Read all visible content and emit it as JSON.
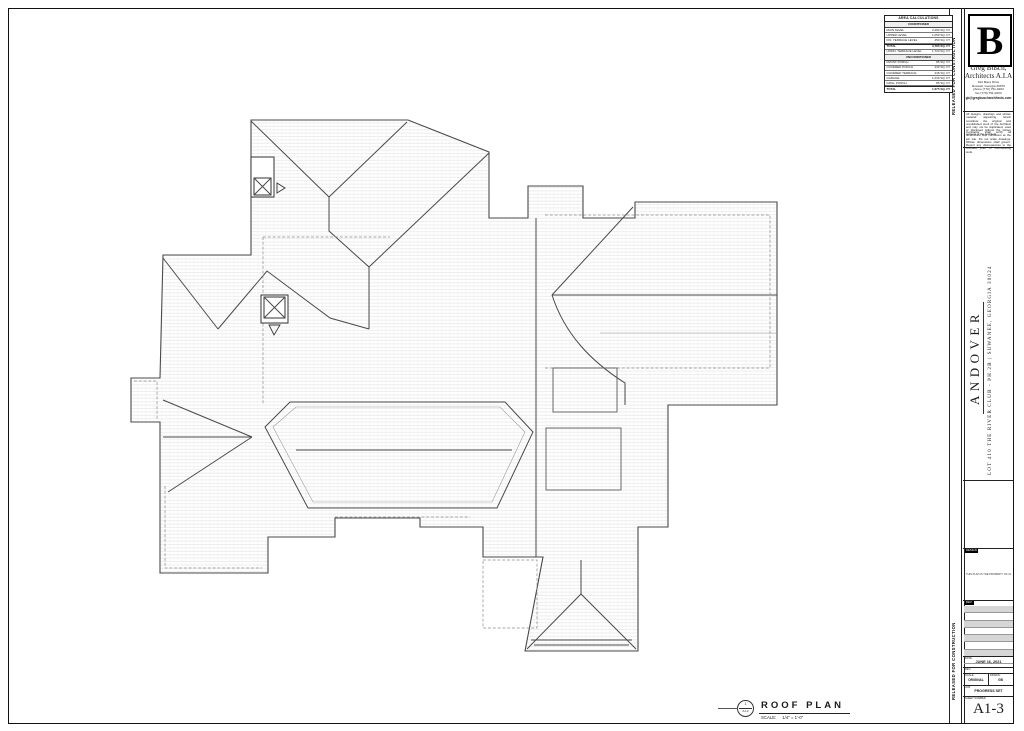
{
  "sheet": {
    "stamp_vertical": "RELEASED FOR CONSTRUCTION",
    "drawing_title": "ROOF PLAN",
    "drawing_scale": "SCALE:     1/4\" = 1'-0\"",
    "title_marker": {
      "number": "1",
      "sheet": "A1-3"
    }
  },
  "area_table": {
    "title": "AREA CALCULATIONS",
    "unit_suffix": "SQ. FT.",
    "sections": [
      {
        "header": "CONDITIONED",
        "rows": [
          [
            "MAIN LEVEL",
            "2,280 SQ. FT."
          ],
          [
            "UPPER LEVEL",
            "1,050 SQ. FT."
          ],
          [
            "FIN. TERRACE LEVEL",
            "450 SQ. FT."
          ],
          [
            "TOTAL",
            "3,780 SQ. FT."
          ],
          [
            "UNFIN. TERRACE LEVEL",
            "1,720 SQ. FT."
          ]
        ],
        "total_indexes": [
          3
        ]
      },
      {
        "header": "UNCONDITIONED",
        "rows": [
          [
            "FRONT PORCH",
            "85 SQ. FT."
          ],
          [
            "COVERED PORCH",
            "230 SQ. FT."
          ],
          [
            "COVERED TERRACE",
            "245 SQ. FT."
          ],
          [
            "GARAGE",
            "1,030 SQ. FT."
          ],
          [
            "GRILL PORCH",
            "85 SQ. FT."
          ],
          [
            "TOTAL",
            "1,675 SQ. FT."
          ]
        ],
        "total_indexes": [
          5
        ]
      }
    ]
  },
  "title_block": {
    "logo_letter": "B",
    "firm_name_line1": "Greg Busch,",
    "firm_name_line2": "Architects A.I.A",
    "address_lines": [
      "102 Macy Drive",
      "Roswell, Georgia 30076",
      "phone (770) 751-0202",
      "fax (770) 751-0203"
    ],
    "email": "gb@gregbuscharchitects.com",
    "disclaimer1": "All designs, drawings and written material appearing herein constitute the original and unpublished work of the Architect and may not be duplicated, used or disclosed without the written consent of the Architect.",
    "disclaimer2": "Contractor shall verify all dimensions and conditions at the job site. Do not scale drawings. Written dimensions shall govern. Report any discrepancies to the Architect prior to commencing work.",
    "project_name": "ANDOVER",
    "project_address": "LOT 410 THE RIVER CLUB - PH.2B | SUWANEE, GEORGIA 30024",
    "design_tag": "DESIGN",
    "design_note": "THIS PLAN IS THE PROPERTY OF GREG BUSCH ARCHITECTS A.I.A",
    "rev_tag": "REV:",
    "revision_row_count": 8,
    "date_label": "DATE:",
    "date_value": "JUNE 16, 2021",
    "rev_label": "REV:",
    "scale_label": "SCALE:",
    "scale_value": "ORIGINAL",
    "drawn_label": "DRAWN:",
    "drawn_value": "GB",
    "job_label": "JOB:",
    "job_value": "PROGRESS SET",
    "sheet_number_label": "SHEET NUMBER",
    "sheet_number": "A1-3"
  },
  "colors": {
    "line": "#4a4a4a",
    "hatch": "#d9d9d9",
    "paper": "#ffffff"
  },
  "drawing": {
    "masses": [
      "M251,120 L408,120 L489,152 L489,218 L528,218 L528,186 L583,186 L583,218 L635,218 L635,202 L777,202 L777,405 L668,405 L668,527 L638,527 L638,651 L525,651 L543,557 L483,557 L483,527 L420,527 L420,518 L335,518 L335,537 L268,537 L268,573 L160,573 L160,422 L131,422 L131,378 L160,378 L163,255 L251,255 Z"
    ],
    "lines": [
      "M251,121 L329,197",
      "M407,122 L329,197",
      "M329,197 L329,231 L369,267 L369,329",
      "M489,153 L369,267",
      "M218,329 L267,271 L330,318 L369,329",
      "M163,258 L218,329",
      "M633,207 L552,295",
      "M552,295 L777,295",
      "M552,295 C565,335 592,362 625,383 L625,405",
      "M536,218 L536,557",
      "M527,649 L581,594 L636,649",
      "M581,594 L581,560",
      "M531,640 L632,640",
      "M534,645 L629,645",
      "M163,400 L252,437",
      "M252,437 L168,492",
      "M163,437 L252,437",
      "M290,402 L505,402 L533,432 L497,508 L308,508 L265,427 Z",
      "M296,450 L512,450",
      "M251,176 L274,176"
    ],
    "light_lines": [
      "M600,333 L777,333",
      "M296,407 L500,407 L525,432 L492,502 L313,502 L273,427 Z"
    ],
    "dashed": [
      "M263,237 L390,237 M263,237 L263,405",
      "M545,215 L770,215 L770,368 L545,368",
      "M483,560 L537,560 L537,628 L483,628 Z",
      "M165,486 L165,568 L262,568",
      "M335,517 L470,517",
      "M134,381 L157,381 L157,419"
    ],
    "rects": [
      {
        "x": 553,
        "y": 368,
        "w": 64,
        "h": 44
      },
      {
        "x": 546,
        "y": 428,
        "w": 75,
        "h": 62
      }
    ],
    "chimney_rects": [
      {
        "x": 251,
        "y": 157,
        "w": 23,
        "h": 40
      },
      {
        "x": 261,
        "y": 295,
        "w": 27,
        "h": 28
      }
    ],
    "xboxes": [
      {
        "x": 254,
        "y": 178,
        "s": 17
      },
      {
        "x": 264,
        "y": 297,
        "s": 21
      }
    ],
    "tris": [
      "M277,183 L285,188 L277,193 Z",
      "M269,325 L280,325 L274,335 Z"
    ]
  }
}
